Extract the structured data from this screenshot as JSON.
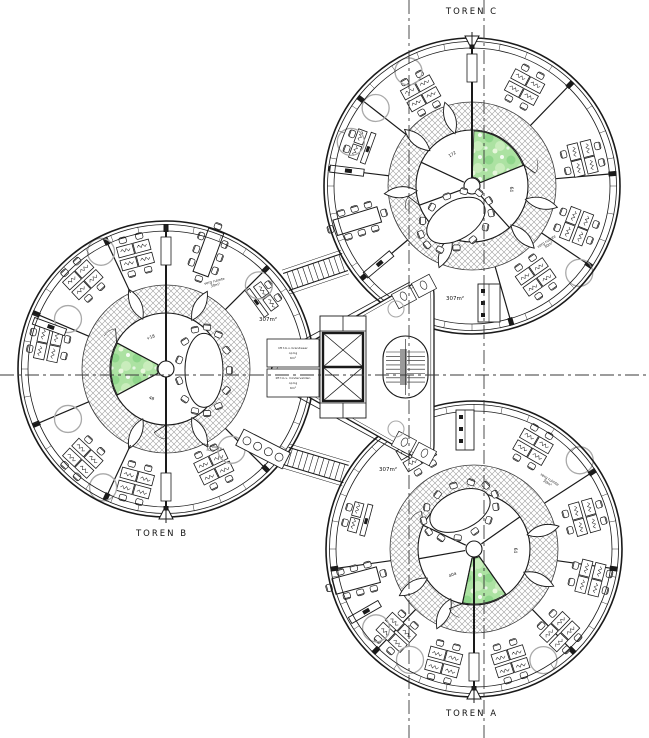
{
  "labels": {
    "toren_c": "TOREN C",
    "toren_b": "TOREN B",
    "toren_a": "TOREN A"
  },
  "area_labels": [
    {
      "text": "307m²",
      "x": 268,
      "y": 320
    },
    {
      "text": "307m²",
      "x": 455,
      "y": 299
    },
    {
      "text": "307m²",
      "x": 388,
      "y": 470
    }
  ],
  "micro_labels": [
    {
      "l1": "verg ruimte",
      "l2": "30m²",
      "x": 215,
      "y": 284,
      "rot": -14
    },
    {
      "l1": "verg ruimte",
      "l2": "30m²",
      "x": 548,
      "y": 244,
      "rot": -32
    },
    {
      "l1": "verg ruimte",
      "l2": "30m²",
      "x": 211,
      "y": 449,
      "rot": 14
    },
    {
      "l1": "verg ruimte",
      "l2": "30m²",
      "x": 548,
      "y": 482,
      "rot": 32
    }
  ],
  "colors": {
    "line": "#1a1a1a",
    "hatch_line": "#9b9b9b",
    "ring_edge": "#3c3c3c",
    "green_base": "#ace2a2",
    "green_dark": "#8fd68b",
    "green_light": "#c9edbc",
    "furniture_gray": "#a9a9a9",
    "stair_gray": "#9a9a9a",
    "axis": "#3a3a3a"
  },
  "core": {
    "lift_labels": [
      [
        "lift t.b.v. brandweer",
        "op bg",
        "6m²"
      ],
      [
        "lift t.b.v. mindervaliden",
        "op bg",
        "6m²"
      ]
    ]
  },
  "plan": {
    "axes": {
      "vertical": [
        409,
        484
      ],
      "horizontal": [
        375
      ]
    },
    "bridges": [
      {
        "x1": 286,
        "y1": 282,
        "x2": 345,
        "y2": 262
      },
      {
        "x1": 286,
        "y1": 456,
        "x2": 346,
        "y2": 474
      }
    ],
    "core_geo": {
      "triangle": [
        [
          434,
          272
        ],
        [
          434,
          468
        ],
        [
          261,
          370
        ]
      ],
      "corner_radius": 24,
      "elevator": {
        "x": 320,
        "y": 316,
        "w": 46,
        "h": 102
      },
      "stair": {
        "x": 383,
        "y": 336,
        "w": 45,
        "h": 62
      },
      "cells": [
        {
          "x": 267,
          "y": 339,
          "w": 52,
          "h": 28
        },
        {
          "x": 267,
          "y": 369,
          "w": 52,
          "h": 28
        }
      ]
    },
    "towers": [
      {
        "id": "toren-c",
        "cx": 472,
        "cy": 186,
        "green": [
          -88,
          -22
        ],
        "inner_walls": [
          -90,
          -22,
          48,
          160,
          205
        ],
        "petals": [
          -108,
          -140,
          175,
          14,
          45,
          112
        ],
        "oval": {
          "a": 115,
          "d": 38,
          "rx": 32,
          "ry": 19,
          "rot": -31
        },
        "sector_walls": [
          -90,
          -46,
          -5,
          34,
          74,
          140,
          187,
          218
        ],
        "spine": [
          -90
        ],
        "clusters": [
          {
            "a": -119,
            "r": 106
          },
          {
            "a": -62,
            "r": 112
          },
          {
            "a": -14,
            "r": 114
          },
          {
            "a": 21,
            "r": 112
          },
          {
            "a": 55,
            "r": 111
          }
        ],
        "meeting": {
          "a": 163,
          "r": 120
        },
        "desk_pair": {
          "a": -160,
          "r": 117
        },
        "circles": [
          {
            "a": -119,
            "r": 131
          },
          {
            "a": -141,
            "r": 124
          },
          {
            "a": 200,
            "r": 129
          },
          {
            "a": 39,
            "r": 138
          }
        ],
        "cabinets": [
          {
            "a": 140,
            "r": 122
          },
          {
            "a": 187,
            "r": 126
          }
        ],
        "tags": [
          {
            "t": "172",
            "a": -122,
            "r": 36,
            "rot": -30
          },
          {
            "t": "64",
            "a": 5,
            "r": 38,
            "rot": 90
          }
        ],
        "marker": -90,
        "pantry": {
          "type": "rect",
          "x": 478,
          "y": 284,
          "w": 22,
          "h": 38
        }
      },
      {
        "id": "toren-b",
        "cx": 166,
        "cy": 369,
        "green": [
          152,
          208
        ],
        "inner_walls": [
          -90,
          90,
          152,
          208
        ],
        "petals": [
          -62,
          -115,
          62,
          115
        ],
        "oval": {
          "a": 2,
          "d": 38,
          "rx": 19,
          "ry": 37,
          "rot": 0
        },
        "sector_walls": [
          -90,
          -115,
          -157,
          -45,
          45,
          90,
          115,
          157
        ],
        "spine": [
          -90,
          90
        ],
        "clusters": [
          {
            "a": -105,
            "r": 118
          },
          {
            "a": -133,
            "r": 122
          },
          {
            "a": 192,
            "r": 120
          },
          {
            "a": 133,
            "r": 122
          },
          {
            "a": 105,
            "r": 118
          },
          {
            "a": 64,
            "r": 109
          }
        ],
        "meeting": {
          "a": -70,
          "r": 124
        },
        "desk_pair": {
          "a": -36,
          "r": 119
        },
        "circles": [
          {
            "a": -119,
            "r": 134
          },
          {
            "a": 207,
            "r": 110
          },
          {
            "a": -42,
            "r": 125
          },
          {
            "a": 118,
            "r": 134
          },
          {
            "a": 153,
            "r": 110
          },
          {
            "a": 51,
            "r": 104
          }
        ],
        "cabinets": [
          {
            "a": 200,
            "r": 124
          }
        ],
        "tags": [
          {
            "t": "+18",
            "a": -116,
            "r": 34,
            "rot": -20
          },
          {
            "t": "48",
            "a": 116,
            "r": 34,
            "rot": 20
          }
        ],
        "marker": 90,
        "pantry": {
          "type": "circles",
          "x": 263,
          "y": 449,
          "rot": 27
        }
      },
      {
        "id": "toren-a",
        "cx": 474,
        "cy": 549,
        "green": [
          55,
          102
        ],
        "inner_walls": [
          55,
          102,
          -35,
          -155,
          170
        ],
        "petals": [
          -15,
          25,
          115,
          148
        ],
        "oval": {
          "a": -110,
          "d": 41,
          "rx": 32,
          "ry": 19,
          "rot": -25
        },
        "sector_walls": [
          90,
          46,
          8,
          -33,
          134,
          172
        ],
        "spine": [
          90
        ],
        "clusters": [
          {
            "a": -121,
            "r": 112
          },
          {
            "a": -60,
            "r": 118
          },
          {
            "a": -16,
            "r": 115
          },
          {
            "a": 14,
            "r": 120
          },
          {
            "a": 44,
            "r": 119
          },
          {
            "a": 72,
            "r": 118
          },
          {
            "a": 105,
            "r": 117
          },
          {
            "a": 133,
            "r": 114
          }
        ],
        "meeting": {
          "a": 165,
          "r": 122
        },
        "desk_pair": {
          "a": 195,
          "r": 118
        },
        "circles": [
          {
            "a": 120,
            "r": 128
          },
          {
            "a": 58,
            "r": 131
          },
          {
            "a": 141,
            "r": 126
          },
          {
            "a": -40,
            "r": 138
          }
        ],
        "cabinets": [
          {
            "a": 150,
            "r": 126
          }
        ],
        "tags": [
          {
            "t": "64",
            "a": 2,
            "r": 40,
            "rot": 90
          },
          {
            "t": "40a",
            "a": 128,
            "r": 34,
            "rot": -25
          }
        ],
        "marker": 90,
        "pantry": {
          "type": "rect",
          "x": 456,
          "y": 410,
          "w": 18,
          "h": 40
        }
      }
    ]
  }
}
